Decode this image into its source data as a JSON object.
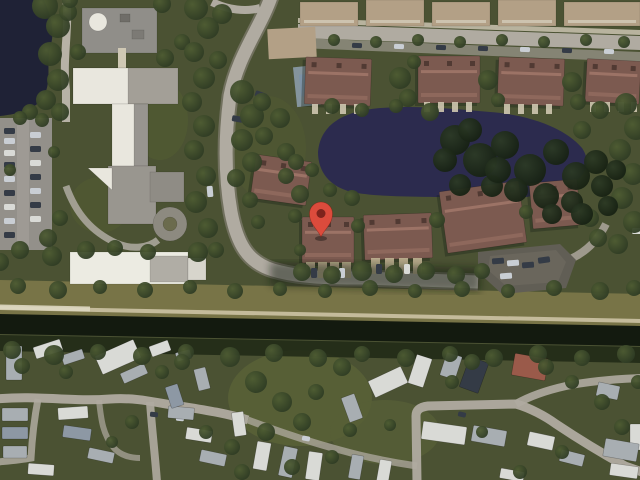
{
  "app": {
    "type": "satellite-map-view",
    "description": "Aerial satellite imagery of a residential area with pond, canal, school, townhomes and mobile home park, marked with a red location pin"
  },
  "marker": {
    "transform": "translate(321,237)",
    "color": "#DC4B3C",
    "inner_color": "#7E231C",
    "shadow": "rgba(0,0,0,0.35)"
  },
  "palette": {
    "grass": "#4b5233",
    "grass_light": "#5a6338",
    "tree": "#3a482b",
    "tree_dark": "#1f2c19",
    "water_lake": "#1f2236",
    "water_pond": "#2c2b4e",
    "water_canal": "#131a0f",
    "bank_grass": "#787447",
    "bank_path": "#c4bb9b",
    "road": "#b0aba1",
    "road_dim": "#8a867c",
    "walk": "#d3ccb9",
    "parking": "#93908a",
    "roof_condo": "#7c5a50",
    "roof_condo_light": "#a07668",
    "roof_tan": "#b3a086",
    "school_white": "#e9e7de",
    "school_gray": "#989590",
    "mobile_white": "#d9dad6",
    "mobile_gray": "#a8aeb2",
    "mobile_blue": "#8d98a4",
    "roof_mobile_red": "#9a5a4a",
    "car_dark": "#343b46",
    "car_silver": "#c9ced4",
    "pool": "#7d92a6",
    "pavement_dark": "#615e55"
  },
  "scene": {
    "trees": [
      [
        45,
        6,
        13
      ],
      [
        58,
        26,
        12
      ],
      [
        50,
        54,
        12
      ],
      [
        58,
        80,
        11
      ],
      [
        46,
        100,
        10
      ],
      [
        68,
        12,
        9
      ],
      [
        30,
        112,
        8
      ],
      [
        60,
        112,
        9
      ],
      [
        20,
        118,
        7
      ],
      [
        42,
        120,
        7
      ],
      [
        10,
        170,
        6
      ],
      [
        54,
        152,
        6
      ],
      [
        20,
        250,
        9
      ],
      [
        52,
        256,
        10
      ],
      [
        86,
        250,
        9
      ],
      [
        115,
        248,
        8
      ],
      [
        0,
        262,
        9
      ],
      [
        148,
        252,
        8
      ],
      [
        60,
        218,
        8
      ],
      [
        48,
        238,
        9
      ],
      [
        78,
        52,
        8
      ],
      [
        165,
        58,
        9
      ],
      [
        182,
        42,
        8
      ],
      [
        162,
        4,
        9
      ],
      [
        70,
        0,
        8
      ],
      [
        196,
        8,
        12
      ],
      [
        208,
        28,
        11
      ],
      [
        194,
        52,
        10
      ],
      [
        204,
        78,
        11
      ],
      [
        192,
        102,
        10
      ],
      [
        204,
        126,
        11
      ],
      [
        194,
        150,
        10
      ],
      [
        206,
        176,
        10
      ],
      [
        196,
        202,
        11
      ],
      [
        208,
        228,
        10
      ],
      [
        198,
        252,
        10
      ],
      [
        222,
        14,
        10
      ],
      [
        218,
        60,
        9
      ],
      [
        216,
        250,
        8
      ],
      [
        242,
        92,
        12
      ],
      [
        252,
        116,
        12
      ],
      [
        242,
        140,
        11
      ],
      [
        252,
        162,
        10
      ],
      [
        236,
        178,
        9
      ],
      [
        262,
        102,
        9
      ],
      [
        280,
        118,
        10
      ],
      [
        264,
        136,
        9
      ],
      [
        286,
        152,
        9
      ],
      [
        250,
        200,
        8
      ],
      [
        258,
        222,
        7
      ],
      [
        296,
        162,
        8
      ],
      [
        334,
        40,
        6
      ],
      [
        376,
        42,
        6
      ],
      [
        418,
        40,
        6
      ],
      [
        460,
        42,
        6
      ],
      [
        502,
        40,
        6
      ],
      [
        544,
        42,
        6
      ],
      [
        586,
        40,
        6
      ],
      [
        624,
        42,
        6
      ],
      [
        400,
        78,
        11
      ],
      [
        408,
        98,
        9
      ],
      [
        488,
        80,
        10
      ],
      [
        572,
        82,
        10
      ],
      [
        578,
        102,
        8
      ],
      [
        414,
        62,
        7
      ],
      [
        498,
        100,
        7
      ],
      [
        332,
        106,
        8
      ],
      [
        362,
        110,
        7
      ],
      [
        396,
        106,
        7
      ],
      [
        430,
        112,
        9
      ],
      [
        300,
        194,
        9
      ],
      [
        286,
        176,
        8
      ],
      [
        312,
        170,
        7
      ],
      [
        330,
        190,
        7
      ],
      [
        352,
        198,
        8
      ],
      [
        295,
        216,
        7
      ],
      [
        358,
        226,
        7
      ],
      [
        437,
        220,
        8
      ],
      [
        526,
        212,
        7
      ],
      [
        300,
        250,
        6
      ],
      [
        626,
        104,
        11
      ],
      [
        636,
        128,
        12
      ],
      [
        620,
        150,
        11
      ],
      [
        633,
        174,
        11
      ],
      [
        622,
        198,
        11
      ],
      [
        634,
        222,
        11
      ],
      [
        618,
        244,
        10
      ],
      [
        598,
        238,
        9
      ],
      [
        590,
        218,
        9
      ],
      [
        582,
        130,
        9
      ],
      [
        600,
        110,
        9
      ],
      [
        302,
        272,
        9
      ],
      [
        332,
        275,
        9
      ],
      [
        362,
        271,
        10
      ],
      [
        394,
        274,
        9
      ],
      [
        426,
        271,
        9
      ],
      [
        456,
        275,
        9
      ],
      [
        482,
        271,
        8
      ],
      [
        18,
        286,
        8
      ],
      [
        58,
        290,
        9
      ],
      [
        100,
        287,
        7
      ],
      [
        145,
        290,
        8
      ],
      [
        190,
        287,
        7
      ],
      [
        235,
        291,
        8
      ],
      [
        280,
        289,
        7
      ],
      [
        325,
        291,
        7
      ],
      [
        370,
        288,
        8
      ],
      [
        415,
        291,
        7
      ],
      [
        462,
        289,
        8
      ],
      [
        508,
        291,
        7
      ],
      [
        554,
        288,
        8
      ],
      [
        600,
        291,
        9
      ],
      [
        634,
        288,
        8
      ],
      [
        12,
        350,
        9
      ],
      [
        54,
        355,
        10
      ],
      [
        98,
        352,
        8
      ],
      [
        142,
        356,
        9
      ],
      [
        186,
        352,
        8
      ],
      [
        230,
        357,
        10
      ],
      [
        274,
        353,
        9
      ],
      [
        318,
        358,
        9
      ],
      [
        362,
        354,
        8
      ],
      [
        406,
        358,
        9
      ],
      [
        450,
        354,
        8
      ],
      [
        494,
        358,
        9
      ],
      [
        538,
        354,
        9
      ],
      [
        582,
        358,
        8
      ],
      [
        626,
        354,
        9
      ],
      [
        256,
        382,
        11
      ],
      [
        282,
        402,
        10
      ],
      [
        302,
        422,
        9
      ],
      [
        266,
        432,
        9
      ],
      [
        316,
        392,
        8
      ],
      [
        342,
        367,
        9
      ],
      [
        232,
        447,
        8
      ],
      [
        206,
        432,
        7
      ],
      [
        182,
        362,
        8
      ],
      [
        162,
        372,
        7
      ],
      [
        66,
        372,
        7
      ],
      [
        22,
        366,
        8
      ],
      [
        132,
        422,
        7
      ],
      [
        112,
        442,
        6
      ],
      [
        242,
        472,
        8
      ],
      [
        292,
        467,
        8
      ],
      [
        332,
        457,
        7
      ],
      [
        472,
        362,
        8
      ],
      [
        452,
        382,
        7
      ],
      [
        546,
        367,
        8
      ],
      [
        572,
        382,
        7
      ],
      [
        602,
        402,
        8
      ],
      [
        622,
        427,
        8
      ],
      [
        520,
        472,
        7
      ],
      [
        562,
        452,
        7
      ],
      [
        482,
        432,
        6
      ],
      [
        638,
        382,
        7
      ],
      [
        350,
        430,
        7
      ],
      [
        390,
        425,
        6
      ]
    ],
    "trees_dark": [
      [
        455,
        140,
        15
      ],
      [
        480,
        160,
        17
      ],
      [
        505,
        145,
        14
      ],
      [
        530,
        170,
        16
      ],
      [
        556,
        152,
        13
      ],
      [
        576,
        176,
        14
      ],
      [
        596,
        162,
        12
      ],
      [
        546,
        196,
        13
      ],
      [
        516,
        190,
        12
      ],
      [
        492,
        186,
        11
      ],
      [
        572,
        202,
        11
      ],
      [
        602,
        186,
        11
      ],
      [
        616,
        170,
        10
      ],
      [
        608,
        206,
        10
      ],
      [
        582,
        214,
        11
      ],
      [
        552,
        214,
        10
      ],
      [
        470,
        130,
        12
      ],
      [
        498,
        170,
        13
      ],
      [
        445,
        160,
        12
      ],
      [
        460,
        185,
        11
      ]
    ],
    "homes": [
      [
        6,
        346,
        16,
        34,
        0,
        "g"
      ],
      [
        34,
        343,
        28,
        12,
        -18,
        "w"
      ],
      [
        62,
        352,
        22,
        10,
        -18,
        "g"
      ],
      [
        97,
        347,
        42,
        20,
        -24,
        "w"
      ],
      [
        121,
        368,
        26,
        11,
        -24,
        "g"
      ],
      [
        150,
        343,
        20,
        11,
        -20,
        "w"
      ],
      [
        176,
        351,
        15,
        9,
        -15,
        "g"
      ],
      [
        2,
        408,
        26,
        13,
        0,
        "g"
      ],
      [
        2,
        427,
        26,
        12,
        0,
        "b"
      ],
      [
        3,
        446,
        24,
        12,
        0,
        "g"
      ],
      [
        28,
        464,
        26,
        11,
        4,
        "w"
      ],
      [
        58,
        407,
        30,
        12,
        -4,
        "w"
      ],
      [
        63,
        427,
        28,
        12,
        8,
        "b"
      ],
      [
        88,
        450,
        26,
        11,
        12,
        "g"
      ],
      [
        168,
        407,
        26,
        12,
        5,
        "g"
      ],
      [
        186,
        429,
        26,
        12,
        9,
        "w"
      ],
      [
        200,
        452,
        26,
        12,
        12,
        "g"
      ],
      [
        233,
        412,
        12,
        24,
        -8,
        "w"
      ],
      [
        168,
        385,
        13,
        22,
        -18,
        "b"
      ],
      [
        196,
        368,
        12,
        22,
        -14,
        "g"
      ],
      [
        370,
        373,
        36,
        18,
        -25,
        "w"
      ],
      [
        345,
        395,
        14,
        26,
        -20,
        "g"
      ],
      [
        412,
        356,
        16,
        30,
        18,
        "w"
      ],
      [
        443,
        354,
        16,
        24,
        18,
        "g"
      ],
      [
        464,
        359,
        20,
        32,
        20,
        "d"
      ],
      [
        513,
        356,
        34,
        22,
        10,
        "r"
      ],
      [
        597,
        384,
        22,
        14,
        12,
        "g"
      ],
      [
        630,
        424,
        12,
        26,
        0,
        "w"
      ],
      [
        422,
        424,
        44,
        18,
        8,
        "w"
      ],
      [
        472,
        428,
        34,
        16,
        10,
        "g"
      ],
      [
        528,
        434,
        26,
        14,
        12,
        "w"
      ],
      [
        604,
        441,
        34,
        18,
        10,
        "g"
      ],
      [
        610,
        465,
        28,
        12,
        8,
        "w"
      ],
      [
        255,
        442,
        14,
        28,
        10,
        "w"
      ],
      [
        281,
        447,
        14,
        30,
        12,
        "g"
      ],
      [
        307,
        452,
        14,
        28,
        8,
        "w"
      ],
      [
        350,
        455,
        12,
        24,
        10,
        "g"
      ],
      [
        378,
        460,
        12,
        24,
        10,
        "w"
      ],
      [
        500,
        470,
        24,
        10,
        10,
        "w"
      ],
      [
        560,
        452,
        24,
        12,
        14,
        "g"
      ]
    ],
    "cars": [
      [
        4,
        128,
        11,
        6,
        0,
        "d"
      ],
      [
        4,
        138,
        11,
        6,
        0,
        "s"
      ],
      [
        4,
        150,
        11,
        6,
        0,
        "w"
      ],
      [
        4,
        162,
        11,
        6,
        0,
        "d"
      ],
      [
        4,
        176,
        11,
        6,
        0,
        "s"
      ],
      [
        4,
        190,
        11,
        6,
        0,
        "d"
      ],
      [
        4,
        204,
        11,
        6,
        0,
        "w"
      ],
      [
        4,
        218,
        11,
        6,
        0,
        "s"
      ],
      [
        4,
        232,
        11,
        6,
        0,
        "d"
      ],
      [
        30,
        132,
        11,
        6,
        0,
        "s"
      ],
      [
        30,
        146,
        11,
        6,
        0,
        "d"
      ],
      [
        30,
        160,
        11,
        6,
        0,
        "w"
      ],
      [
        30,
        174,
        11,
        6,
        0,
        "d"
      ],
      [
        30,
        188,
        11,
        6,
        0,
        "s"
      ],
      [
        30,
        202,
        11,
        6,
        0,
        "d"
      ],
      [
        30,
        216,
        11,
        6,
        0,
        "w"
      ],
      [
        352,
        43,
        10,
        5,
        2,
        "d"
      ],
      [
        394,
        44,
        10,
        5,
        2,
        "s"
      ],
      [
        436,
        45,
        10,
        5,
        2,
        "d"
      ],
      [
        478,
        46,
        10,
        5,
        2,
        "d"
      ],
      [
        520,
        47,
        10,
        5,
        2,
        "s"
      ],
      [
        562,
        48,
        10,
        5,
        2,
        "d"
      ],
      [
        604,
        49,
        10,
        5,
        2,
        "s"
      ],
      [
        255,
        92,
        12,
        6,
        20,
        "d"
      ],
      [
        232,
        116,
        11,
        6,
        10,
        "d"
      ],
      [
        205,
        170,
        6,
        11,
        -5,
        "d"
      ],
      [
        207,
        186,
        6,
        11,
        -5,
        "s"
      ],
      [
        492,
        258,
        12,
        6,
        -4,
        "d"
      ],
      [
        507,
        260,
        12,
        6,
        -4,
        "s"
      ],
      [
        522,
        262,
        12,
        6,
        -4,
        "d"
      ],
      [
        538,
        257,
        12,
        6,
        -8,
        "d"
      ],
      [
        500,
        273,
        12,
        6,
        -4,
        "s"
      ],
      [
        311,
        268,
        6,
        10,
        0,
        "d"
      ],
      [
        339,
        268,
        6,
        10,
        0,
        "s"
      ],
      [
        376,
        264,
        6,
        10,
        0,
        "d"
      ],
      [
        404,
        264,
        6,
        10,
        0,
        "w"
      ],
      [
        150,
        412,
        8,
        5,
        5,
        "d"
      ],
      [
        176,
        416,
        8,
        5,
        5,
        "s"
      ],
      [
        458,
        412,
        8,
        5,
        12,
        "d"
      ],
      [
        302,
        436,
        8,
        5,
        10,
        "s"
      ],
      [
        632,
        228,
        10,
        6,
        0,
        "w"
      ]
    ],
    "condos_top": [
      [
        300,
        2,
        58,
        24
      ],
      [
        366,
        0,
        58,
        26
      ],
      [
        432,
        2,
        58,
        24
      ],
      [
        498,
        0,
        58,
        26
      ],
      [
        564,
        2,
        76,
        24
      ]
    ],
    "condo_rows": [
      [
        305,
        58,
        66,
        47,
        2
      ],
      [
        418,
        56,
        62,
        47,
        0
      ],
      [
        498,
        58,
        66,
        47,
        2
      ],
      [
        586,
        60,
        54,
        43,
        3
      ]
    ],
    "pin_rows": [
      [
        302,
        217,
        52,
        46,
        0
      ],
      [
        364,
        214,
        68,
        45,
        -2
      ],
      [
        443,
        186,
        80,
        62,
        -8
      ],
      [
        531,
        181,
        48,
        46,
        -5
      ],
      [
        253,
        158,
        56,
        44,
        8
      ]
    ],
    "stubs_tan": [
      [
        306,
        262
      ],
      [
        318,
        262
      ],
      [
        330,
        262
      ],
      [
        342,
        262
      ],
      [
        371,
        258
      ],
      [
        385,
        258
      ],
      [
        399,
        258
      ],
      [
        413,
        258
      ]
    ],
    "stubs_walk": [
      [
        312,
        104
      ],
      [
        326,
        104
      ],
      [
        340,
        104
      ],
      [
        354,
        104
      ],
      [
        424,
        102
      ],
      [
        438,
        102
      ],
      [
        452,
        102
      ],
      [
        466,
        102
      ],
      [
        504,
        104
      ],
      [
        518,
        104
      ],
      [
        532,
        104
      ],
      [
        546,
        104
      ],
      [
        590,
        102
      ],
      [
        604,
        102
      ],
      [
        618,
        102
      ],
      [
        631,
        102
      ]
    ]
  }
}
